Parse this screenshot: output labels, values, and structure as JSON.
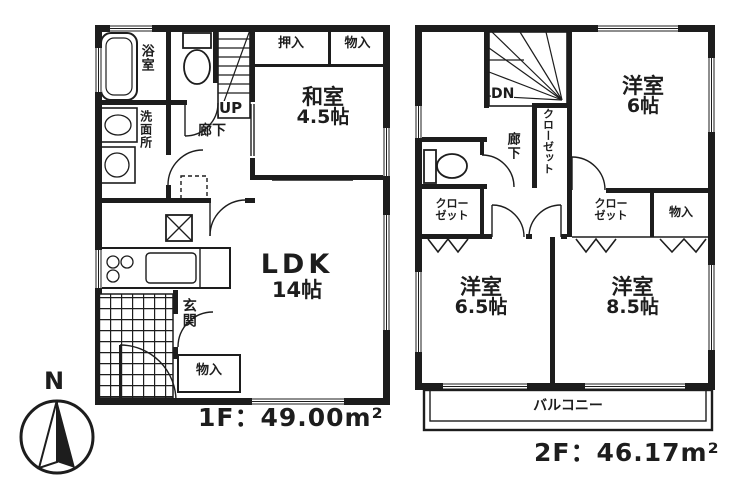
{
  "document": {
    "kind": "floor-plan-scan"
  },
  "colors": {
    "ink": "#1d1d1d",
    "paper": "#ffffff"
  },
  "compass": {
    "north_label": "N"
  },
  "floor1": {
    "area_label": "1F：49.00m²",
    "rooms": {
      "washitsu": {
        "name": "和室",
        "size": "4.5帖"
      },
      "ldk": {
        "name": "LDK",
        "size": "14帖"
      },
      "bath": {
        "label": "浴室"
      },
      "washroom": {
        "label": "洗面所"
      },
      "hallway": {
        "label": "廊下"
      },
      "stairs": {
        "label": "UP"
      },
      "entrance": {
        "label": "玄関"
      },
      "closet_oshiire": {
        "label": "押入"
      },
      "closet_monoire": {
        "label": "物入"
      },
      "entrance_storage": {
        "label": "物入"
      }
    }
  },
  "floor2": {
    "area_label": "2F：46.17m²",
    "rooms": {
      "bedroom6": {
        "name": "洋室",
        "size": "6帖"
      },
      "bedroom65": {
        "name": "洋室",
        "size": "6.5帖"
      },
      "bedroom85": {
        "name": "洋室",
        "size": "8.5帖"
      },
      "stairs": {
        "label": "DN"
      },
      "hallway": {
        "label": "廊下"
      },
      "hall_closet": {
        "label": "クローゼット"
      },
      "closet_left": {
        "line1": "クロー",
        "line2": "ゼット"
      },
      "closet_right": {
        "line1": "クロー",
        "line2": "ゼット"
      },
      "storage": {
        "label": "物入"
      },
      "balcony": {
        "label": "バルコニー"
      }
    }
  }
}
